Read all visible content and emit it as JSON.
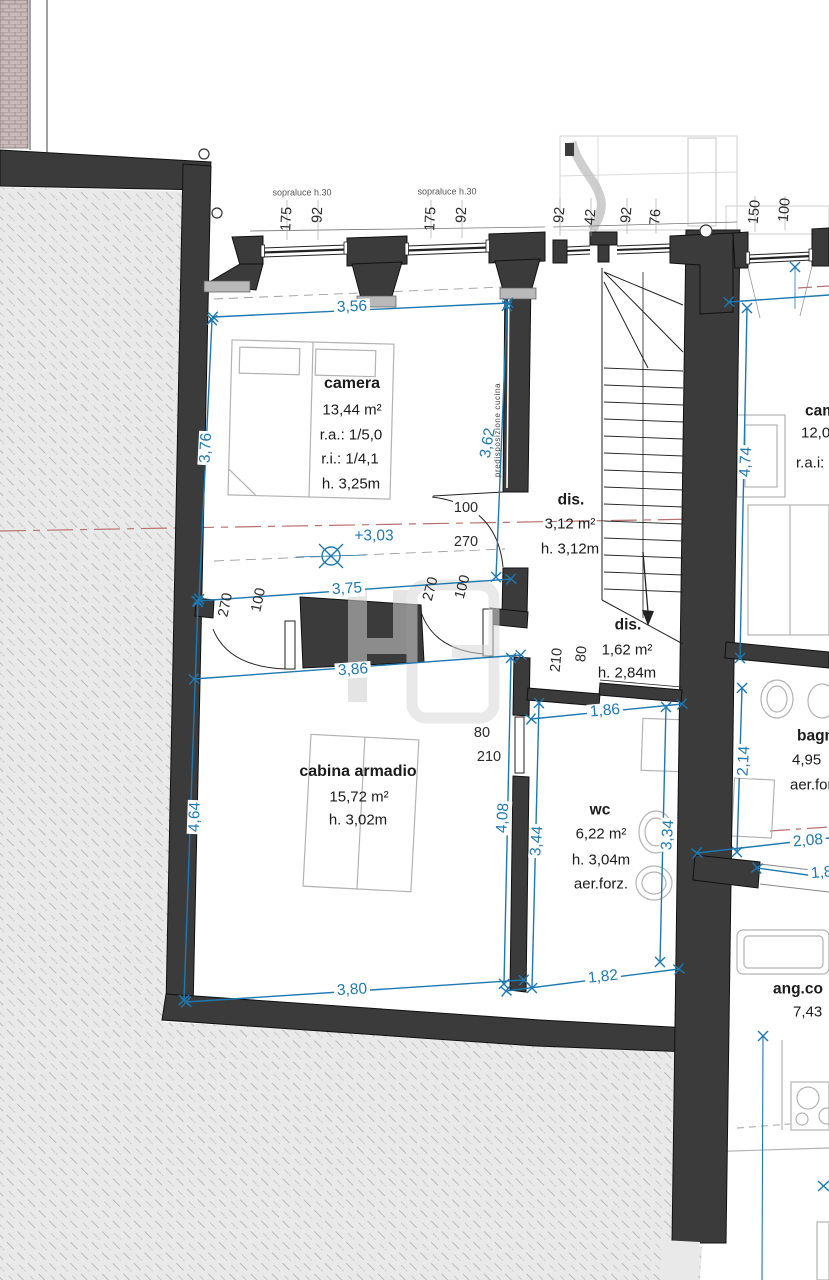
{
  "rooms": {
    "camera": {
      "name": "camera",
      "area": "13,44 m²",
      "line1": "r.a.: 1/5,0",
      "line2": "r.i.: 1/4,1",
      "line3": "h. 3,25m"
    },
    "dis1": {
      "name": "dis.",
      "area": "3,12 m²",
      "line1": "h. 3,12m"
    },
    "dis2": {
      "name": "dis.",
      "area": "1,62 m²",
      "line1": "h. 2,84m"
    },
    "cabina": {
      "name": "cabina armadio",
      "area": "15,72 m²",
      "line1": "h. 3,02m"
    },
    "wc": {
      "name": "wc",
      "area": "6,22 m²",
      "line1": "h. 3,04m",
      "line2": "aer.forz."
    },
    "camera_right": {
      "name": "cam",
      "area": "12,0",
      "line1": "r.a.i:"
    },
    "bagno": {
      "name": "bagn",
      "area": "4,95",
      "line1": "aer.for"
    },
    "ang_cottura": {
      "name": "ang.co",
      "area": "7,43"
    }
  },
  "dims": {
    "top_width": "3,56",
    "camera_left": "3,76",
    "camera_right": "3,62",
    "corridor_top": "3,75",
    "corridor_bottom": "3,86",
    "cabina_left": "4,64",
    "cabina_bottom": "3,80",
    "cabina_right": "4,08",
    "wc_left": "3,44",
    "wc_right": "3,34",
    "wc_top": "1,86",
    "wc_bottom": "1,82",
    "bagno_height": "2,14",
    "bagno_bottom": "2,08",
    "right_partial": "1,8",
    "camera_right_height": "4,74",
    "level": "+3,03"
  },
  "doors": {
    "camera_w": "100",
    "camera_h": "270",
    "corridor_left_h": "270",
    "corridor_left_w": "100",
    "corridor_right_h": "270",
    "corridor_right_w": "100",
    "dis2_h": "210",
    "dis2_w": "80",
    "wc_w": "80",
    "wc_h": "210"
  },
  "windows": {
    "sopraluce_1": "sopraluce h.30",
    "sopraluce_2": "sopraluce h.30",
    "w1_w": "175",
    "w1_h": "92",
    "w2_w": "175",
    "w2_h": "92",
    "w3_a": "92",
    "w3_b": "42",
    "w3_c": "92",
    "w3_d": "76",
    "w4_a": "150",
    "w4_b": "100"
  },
  "annotations": {
    "predisposizione": "predisposizione cucina"
  }
}
